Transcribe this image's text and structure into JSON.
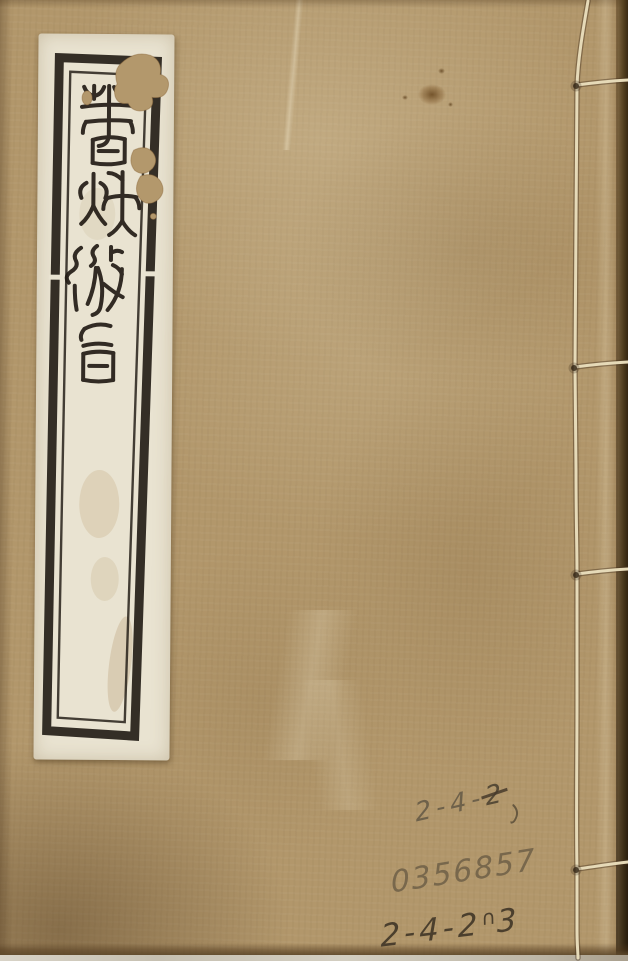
{
  "title_label": {
    "text": "春秋微旨",
    "characters": [
      "春",
      "秋",
      "微",
      "旨"
    ]
  },
  "handwritten": {
    "top": {
      "prefix": "2-4-",
      "struck": "2"
    },
    "accession": "0356857",
    "bottom": {
      "prefix": "2-4-2",
      "squiggle": "∩",
      "suffix": "3"
    }
  },
  "colors": {
    "cover": "#b2976b",
    "cover_shadow": "#5f4a2c",
    "label_paper": "#e9e3d1",
    "stamp_ink": "#24201a",
    "binding_thread": "#e6dab8",
    "right_edge": "#4e3a1f",
    "bottom_edge_sliver": "#cdc7b9",
    "pencil_light": "#685c48",
    "pencil_mid": "#706148",
    "pencil_dark": "#463a2a",
    "stain": "#5a370f"
  }
}
